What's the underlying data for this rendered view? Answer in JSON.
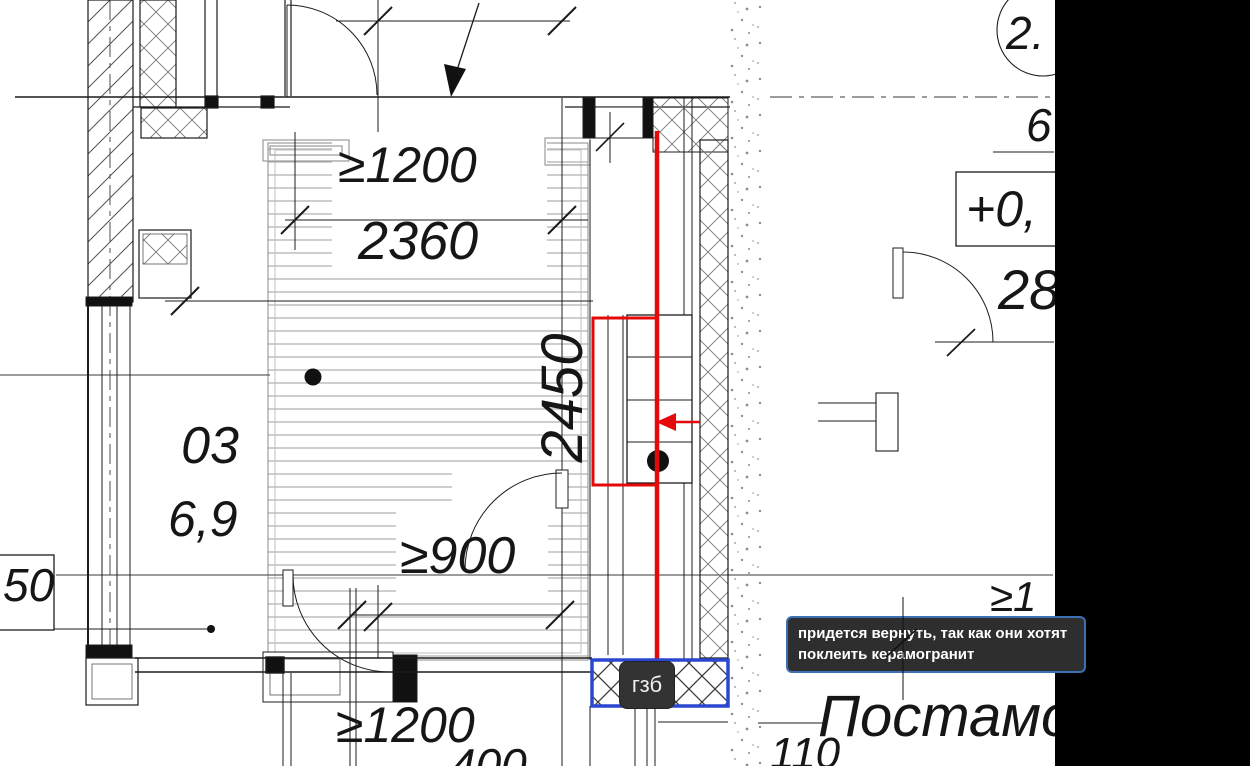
{
  "colors": {
    "red": "#e60909",
    "blue": "#2b46cf",
    "tooltip-border": "#3d6fb3",
    "tooltip-bg": "#2e2e2e",
    "chip-bg": "#333333",
    "band": "#000000"
  },
  "tooltip": {
    "line1": "придется вернуть, так как они хотят",
    "line2": "поклеить керамогранит"
  },
  "chip": {
    "label": "гзб"
  },
  "room": {
    "number": "03",
    "area": "6,9"
  },
  "dimensions": {
    "top_min": "≥1200",
    "top_actual": "2360",
    "side_actual": "2450",
    "door_min": "≥900",
    "bottom_min": "≥1200",
    "bottom_partial": "400",
    "left_partial": "50",
    "bottom_right_partial": "110",
    "right_partial_min": "≥1"
  },
  "marks": {
    "circle_top_right": "2.",
    "right_area": "6",
    "elevation": "+0,",
    "right_dim": "28",
    "pedestal": "Постамо"
  }
}
